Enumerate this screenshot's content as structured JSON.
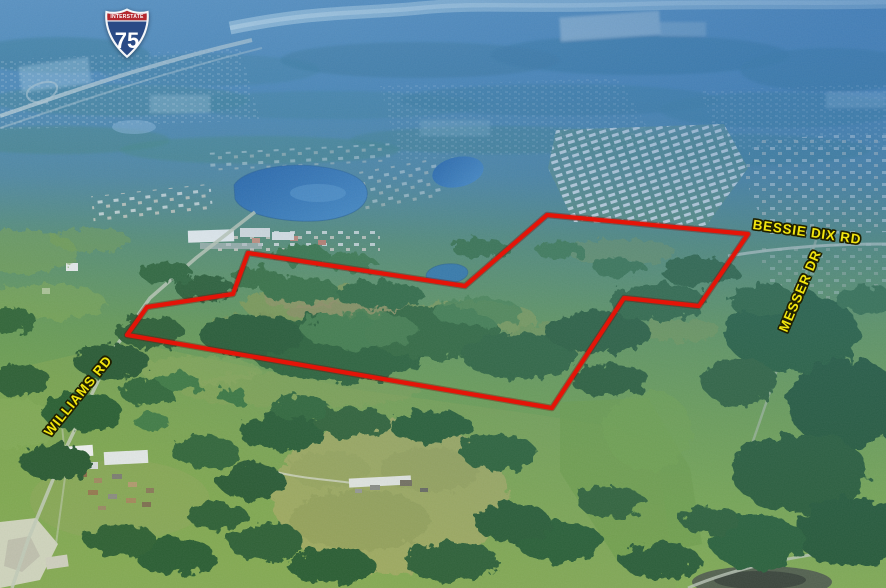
{
  "map": {
    "road_labels": [
      {
        "id": "bessie-dix-rd",
        "text": "BESSIE DIX RD"
      },
      {
        "id": "messer-dr",
        "text": "MESSER DR"
      },
      {
        "id": "williams-rd",
        "text": "WILLIAMS RD"
      }
    ],
    "interstate_shield": {
      "header": "INTERSTATE",
      "route_number": "75"
    },
    "boundary_points_px": "248,253 465,286 547,215 748,234 699,306 624,298 552,408 127,335 147,307 233,294",
    "colors": {
      "boundary_red": "#e41408",
      "label_yellow": "#f2e50e",
      "shield_red": "#b4282e",
      "shield_blue": "#294a86",
      "lake_blue": "#2b6cb4"
    }
  }
}
